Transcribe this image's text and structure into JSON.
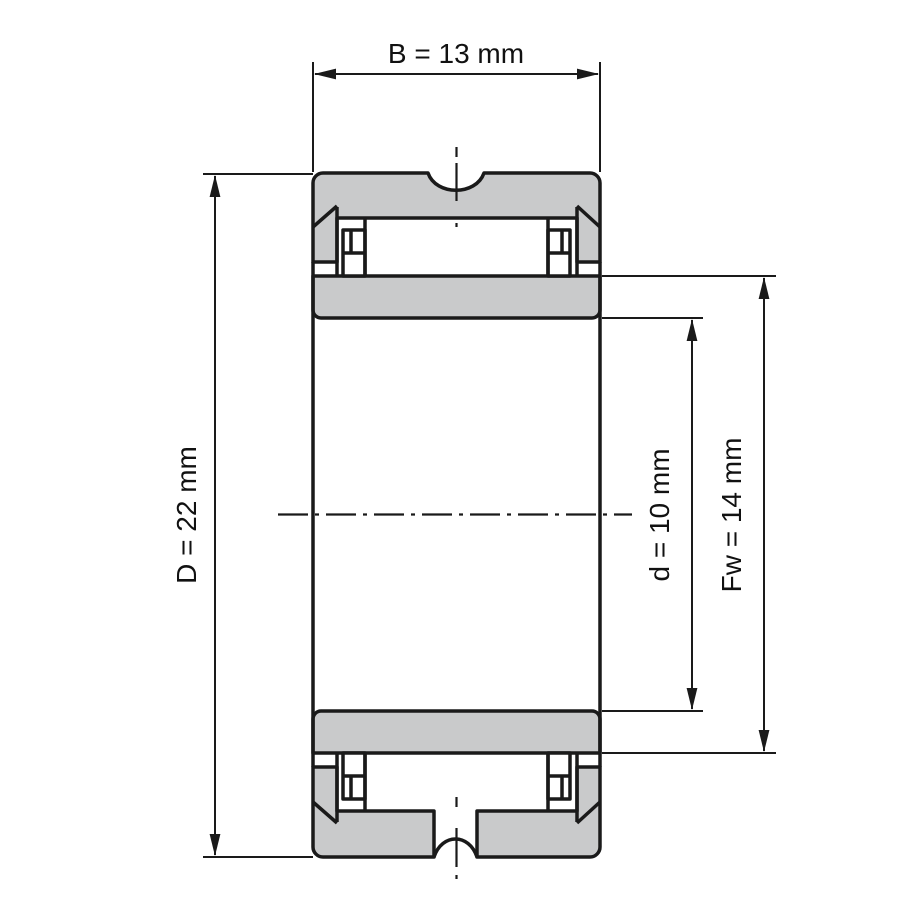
{
  "drawing": {
    "type": "needle-roller-bearing-cross-section",
    "dimensions": {
      "B": {
        "label": "B = 13 mm",
        "symbol": "B",
        "value_mm": 13
      },
      "D": {
        "label": "D = 22 mm",
        "symbol": "D",
        "value_mm": 22
      },
      "d": {
        "label": "d = 10 mm",
        "symbol": "d",
        "value_mm": 10
      },
      "Fw": {
        "label": "Fw = 14 mm",
        "symbol": "Fw",
        "value_mm": 14
      }
    },
    "colors": {
      "section_fill": "#c9cacb",
      "line": "#1a1a1a",
      "background": "#ffffff"
    }
  }
}
